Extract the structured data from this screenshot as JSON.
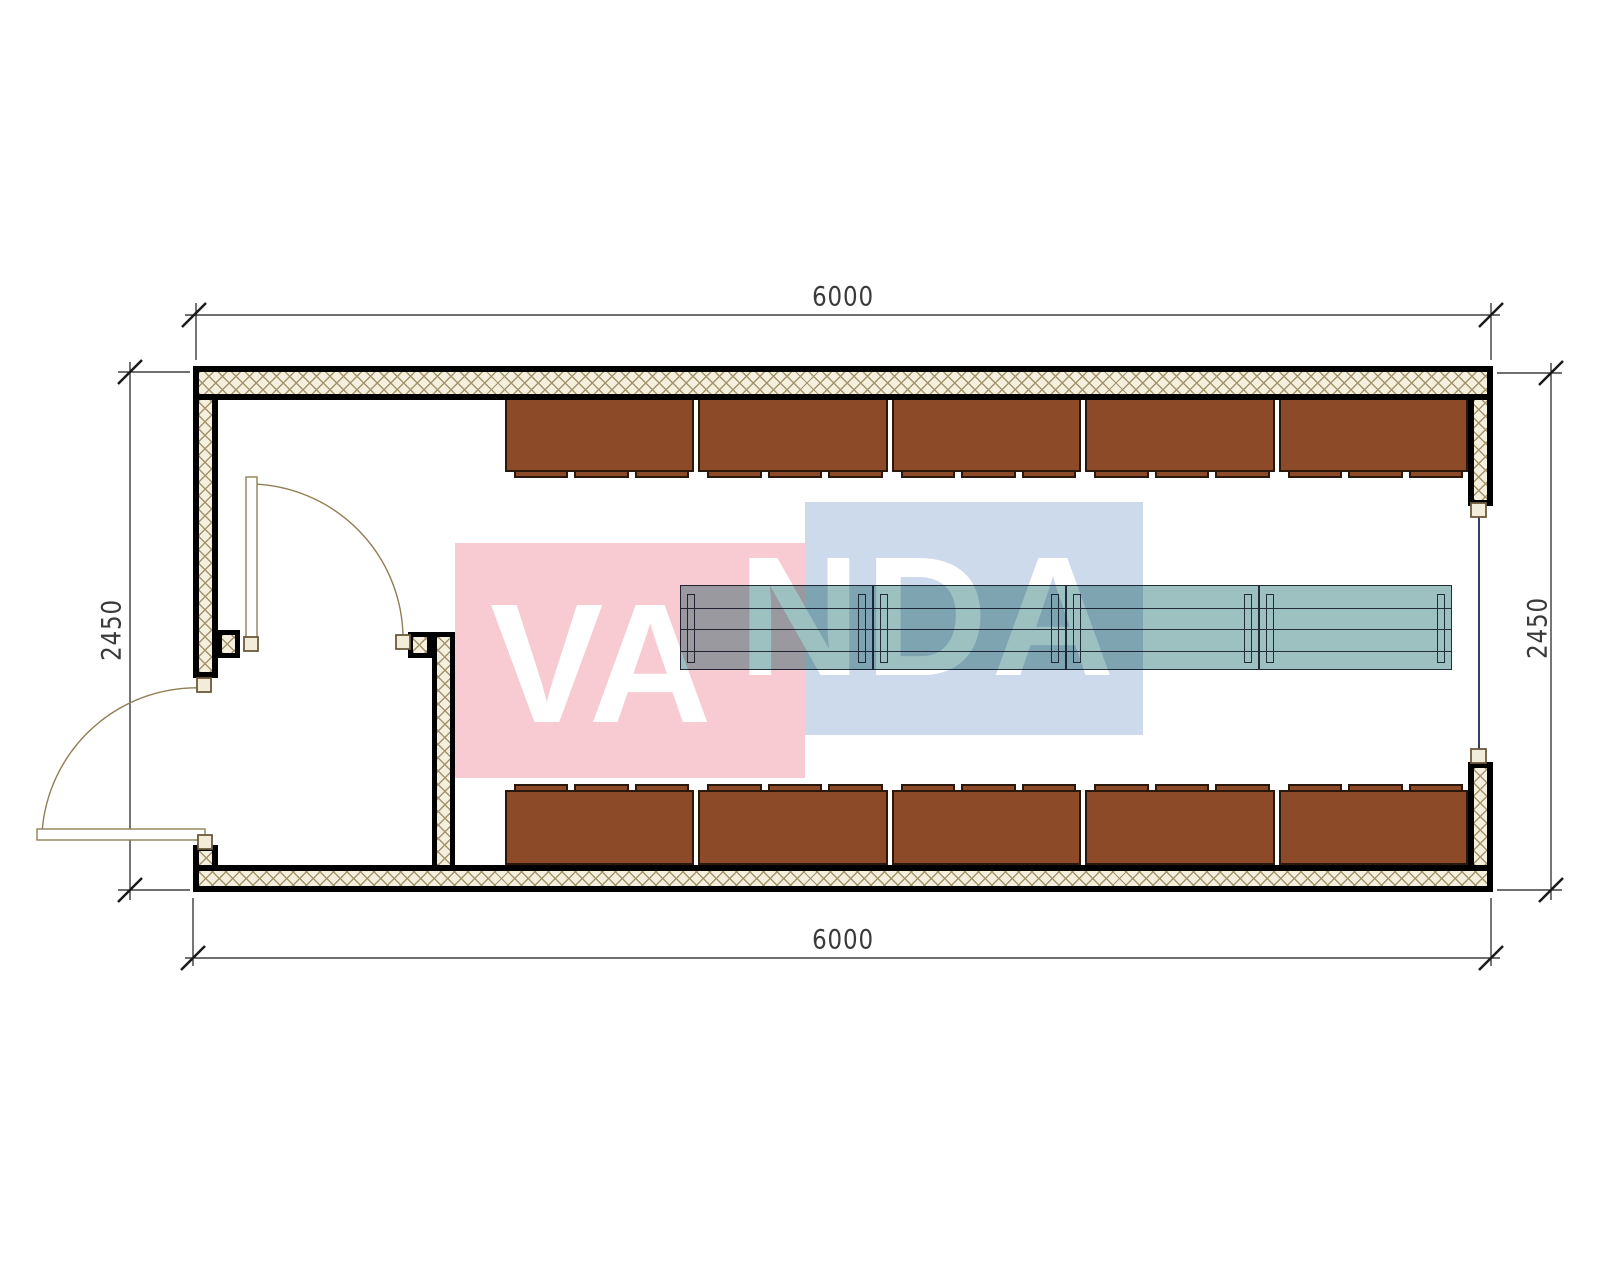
{
  "drawing_type": "floor-plan",
  "watermark": {
    "text": "VANDA",
    "left_part": "VA",
    "right_part": "NDA",
    "red_square_color": "#f8cbd2",
    "blue_square_color": "#ccdaeb",
    "text_color": "#ffffff"
  },
  "dimension_labels": {
    "top": "6000",
    "bottom": "6000",
    "left": "2450",
    "right": "2450"
  },
  "furniture": {
    "locker_rows": [
      {
        "position": "top",
        "sections": 5,
        "feet_per_section": 3
      },
      {
        "position": "bottom",
        "sections": 5,
        "feet_per_section": 3
      }
    ],
    "table_row": {
      "sections": 4,
      "planks_per_section": 4,
      "legs_per_section": 2
    }
  },
  "openings": {
    "exterior_door": "left-wall-bottom",
    "interior_door": "vestibule-partition",
    "window": "right-wall-center"
  },
  "colors": {
    "locker": "#8c4a29",
    "locker_border": "#2b180c",
    "table_fill": "#9dc0c1",
    "table_line": "#222c3a",
    "wall_hatch_bg": "#f5efdd",
    "wall_hatch_line": "#a4946e",
    "door_line": "#8f7f55",
    "jamb_fill": "#f3ecd8",
    "jamb_border": "#6a5a3c",
    "window_line": "#3c3c68",
    "dimension_line": "#1a1a1a",
    "dimension_text": "#3a3a3a"
  }
}
